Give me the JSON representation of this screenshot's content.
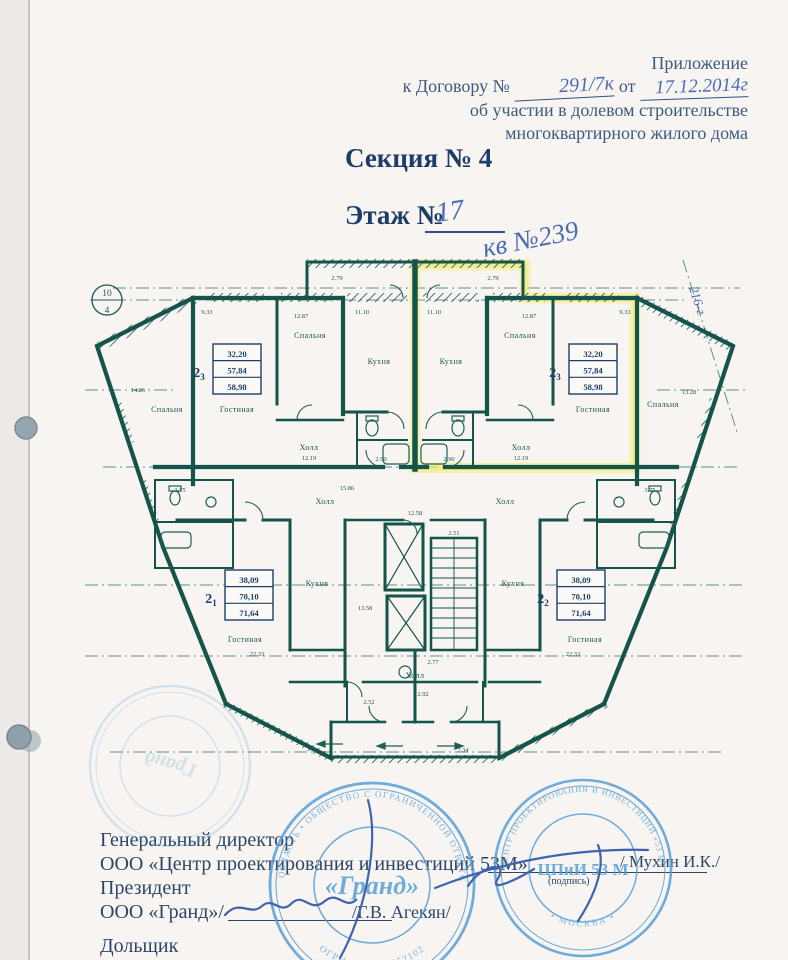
{
  "header": {
    "line1": "Приложение",
    "line2_prefix": "к Договору №",
    "contract_no": "291/7к",
    "line2_mid": "от",
    "contract_date": "17.12.2014г",
    "line3": "об участии в долевом строительстве",
    "line4": "многоквартирного жилого дома"
  },
  "titles": {
    "section": "Секция № 4",
    "floor_label": "Этаж №",
    "floor_value": "17",
    "apartment_note": "кв №239"
  },
  "plan": {
    "axis_circle": {
      "top": "10",
      "bottom": "4"
    },
    "handwritten_note": "216-г",
    "room_labels": {
      "bedroom": "Спальня",
      "living": "Гостиная",
      "kitchen": "Кухня",
      "hall": "Холл"
    },
    "units": [
      {
        "no": "2",
        "sub": "3",
        "areas": [
          "32,20",
          "57,84",
          "58,98"
        ]
      },
      {
        "no": "2",
        "sub": "3",
        "areas": [
          "32,20",
          "57,84",
          "58,98"
        ]
      },
      {
        "no": "2",
        "sub": "1",
        "areas": [
          "38,09",
          "70,10",
          "71,64"
        ]
      },
      {
        "no": "2",
        "sub": "2",
        "areas": [
          "38,09",
          "70,10",
          "71,64"
        ]
      }
    ],
    "dims": {
      "balcony_top": "2.79",
      "kitchen_top": "11.10",
      "living_top": "9.33",
      "bedroom_top": "12.87",
      "wing_left": "14.26",
      "wing_right": "13.28",
      "hall_in": "12.19",
      "hall_common": "15.86",
      "corridor": "12.58",
      "stairs": "2.51",
      "lobby": "2.77",
      "living_low": "22.33",
      "kitchen_low": "13.58",
      "balcony_low": "7.34",
      "room_a": "2.52",
      "room_b": "2.92",
      "bath_a": "2.90",
      "bath_b": "3.75"
    },
    "colors": {
      "wall": "#14544a",
      "highlight": "#f2ea52",
      "hand_blue": "#4a6cb3"
    }
  },
  "footer": {
    "role1": "Генеральный директор",
    "org1": "ООО «Центр проектирования и инвестиций 53М»",
    "sign1_name": "/ Мухин И.К./",
    "sign1_caption": "(подпись)",
    "role2": "Президент",
    "org2": "ООО «Гранд»/",
    "sign2_name": "/Г.В. Агекян/",
    "role3": "Дольщик"
  },
  "stamps": {
    "grand": {
      "center": "«Гранд»",
      "ring_top": "МОСКОВСКАЯ ОБЛАСТЬ • ОБЩЕСТВО С ОГРАНИЧЕННОЙ ОТВЕТСТВЕННОСТЬЮ",
      "ring_bottom": "ОГРН 1045010552102",
      "color": "#4e9bd4"
    },
    "cpii": {
      "center": "ЦПиИ 53 М",
      "ring_top": "ЦЕНТР ПРОЕКТИРОВАНИЯ И ИНВЕСТИЦИЙ «53 М»",
      "ring_bottom": "• МОСКВА •",
      "color": "#4e9bd4"
    },
    "faint": {
      "center": "Гранд"
    }
  }
}
